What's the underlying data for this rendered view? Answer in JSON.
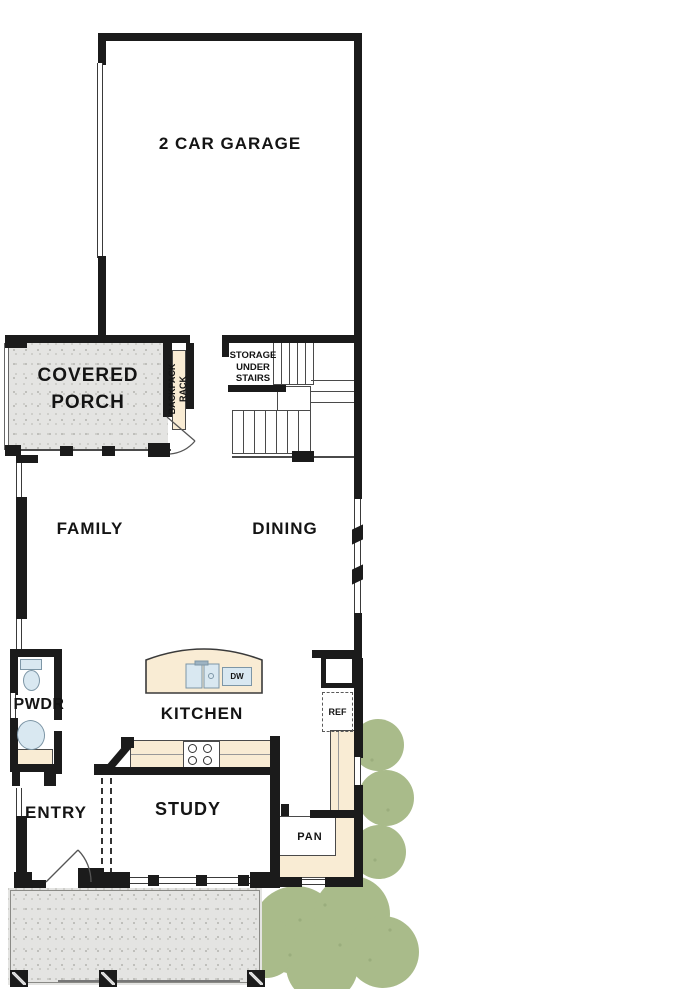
{
  "plan": {
    "rooms": {
      "garage": "2 CAR GARAGE",
      "covered_porch_line1": "COVERED",
      "covered_porch_line2": "PORCH",
      "family": "FAMILY",
      "dining": "DINING",
      "kitchen": "KITCHEN",
      "powder_room": "PWDR",
      "entry": "ENTRY",
      "study": "STUDY",
      "pantry": "PAN"
    },
    "labels": {
      "backpack_rack_line1": "BACKPACK",
      "backpack_rack_line2": "RACK",
      "storage_line1": "STORAGE",
      "storage_line2": "UNDER",
      "storage_line3": "STAIRS",
      "dishwasher": "DW",
      "refrigerator": "REF"
    },
    "colors": {
      "wall_black": "#1b1b1b",
      "porch_gray": "#e4e4e2",
      "counter_beige": "#f9ecd4",
      "fixture_blue": "#d9e8f1",
      "foliage_green": "#a9bb8a"
    }
  }
}
